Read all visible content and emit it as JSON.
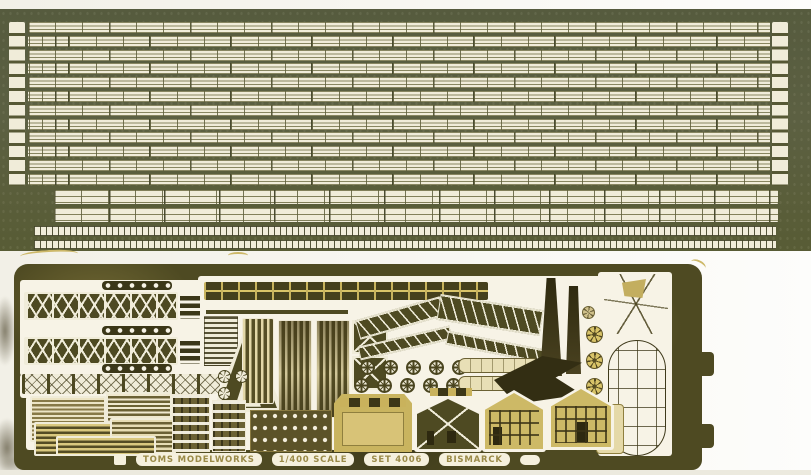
{
  "banner": {
    "brand": "TOMS MODELWORKS",
    "scale": "1/400 SCALE",
    "set_number": "SET 4006",
    "ship_name": "BISMARCK"
  },
  "top_sheet": {
    "railing_rows": 12,
    "wide_railing_rows": 2,
    "ladder_strips": 2
  },
  "bottom_sheet": {
    "pulley_row_a": 5,
    "pulley_row_b": 5,
    "small_wheels": 3,
    "propellers": 4
  },
  "palette": {
    "scan_background": "#f2f0e7",
    "top_fret_base": "#5a5e40",
    "etched_ivory": "#f0ecd9",
    "bottom_fret_base": "#4e4a22",
    "brass_bright": "#c9b45f",
    "brass_pale": "#e8dfb6",
    "cutout_white": "#f7f3e6",
    "banner_text_color": "#9a8a48"
  }
}
